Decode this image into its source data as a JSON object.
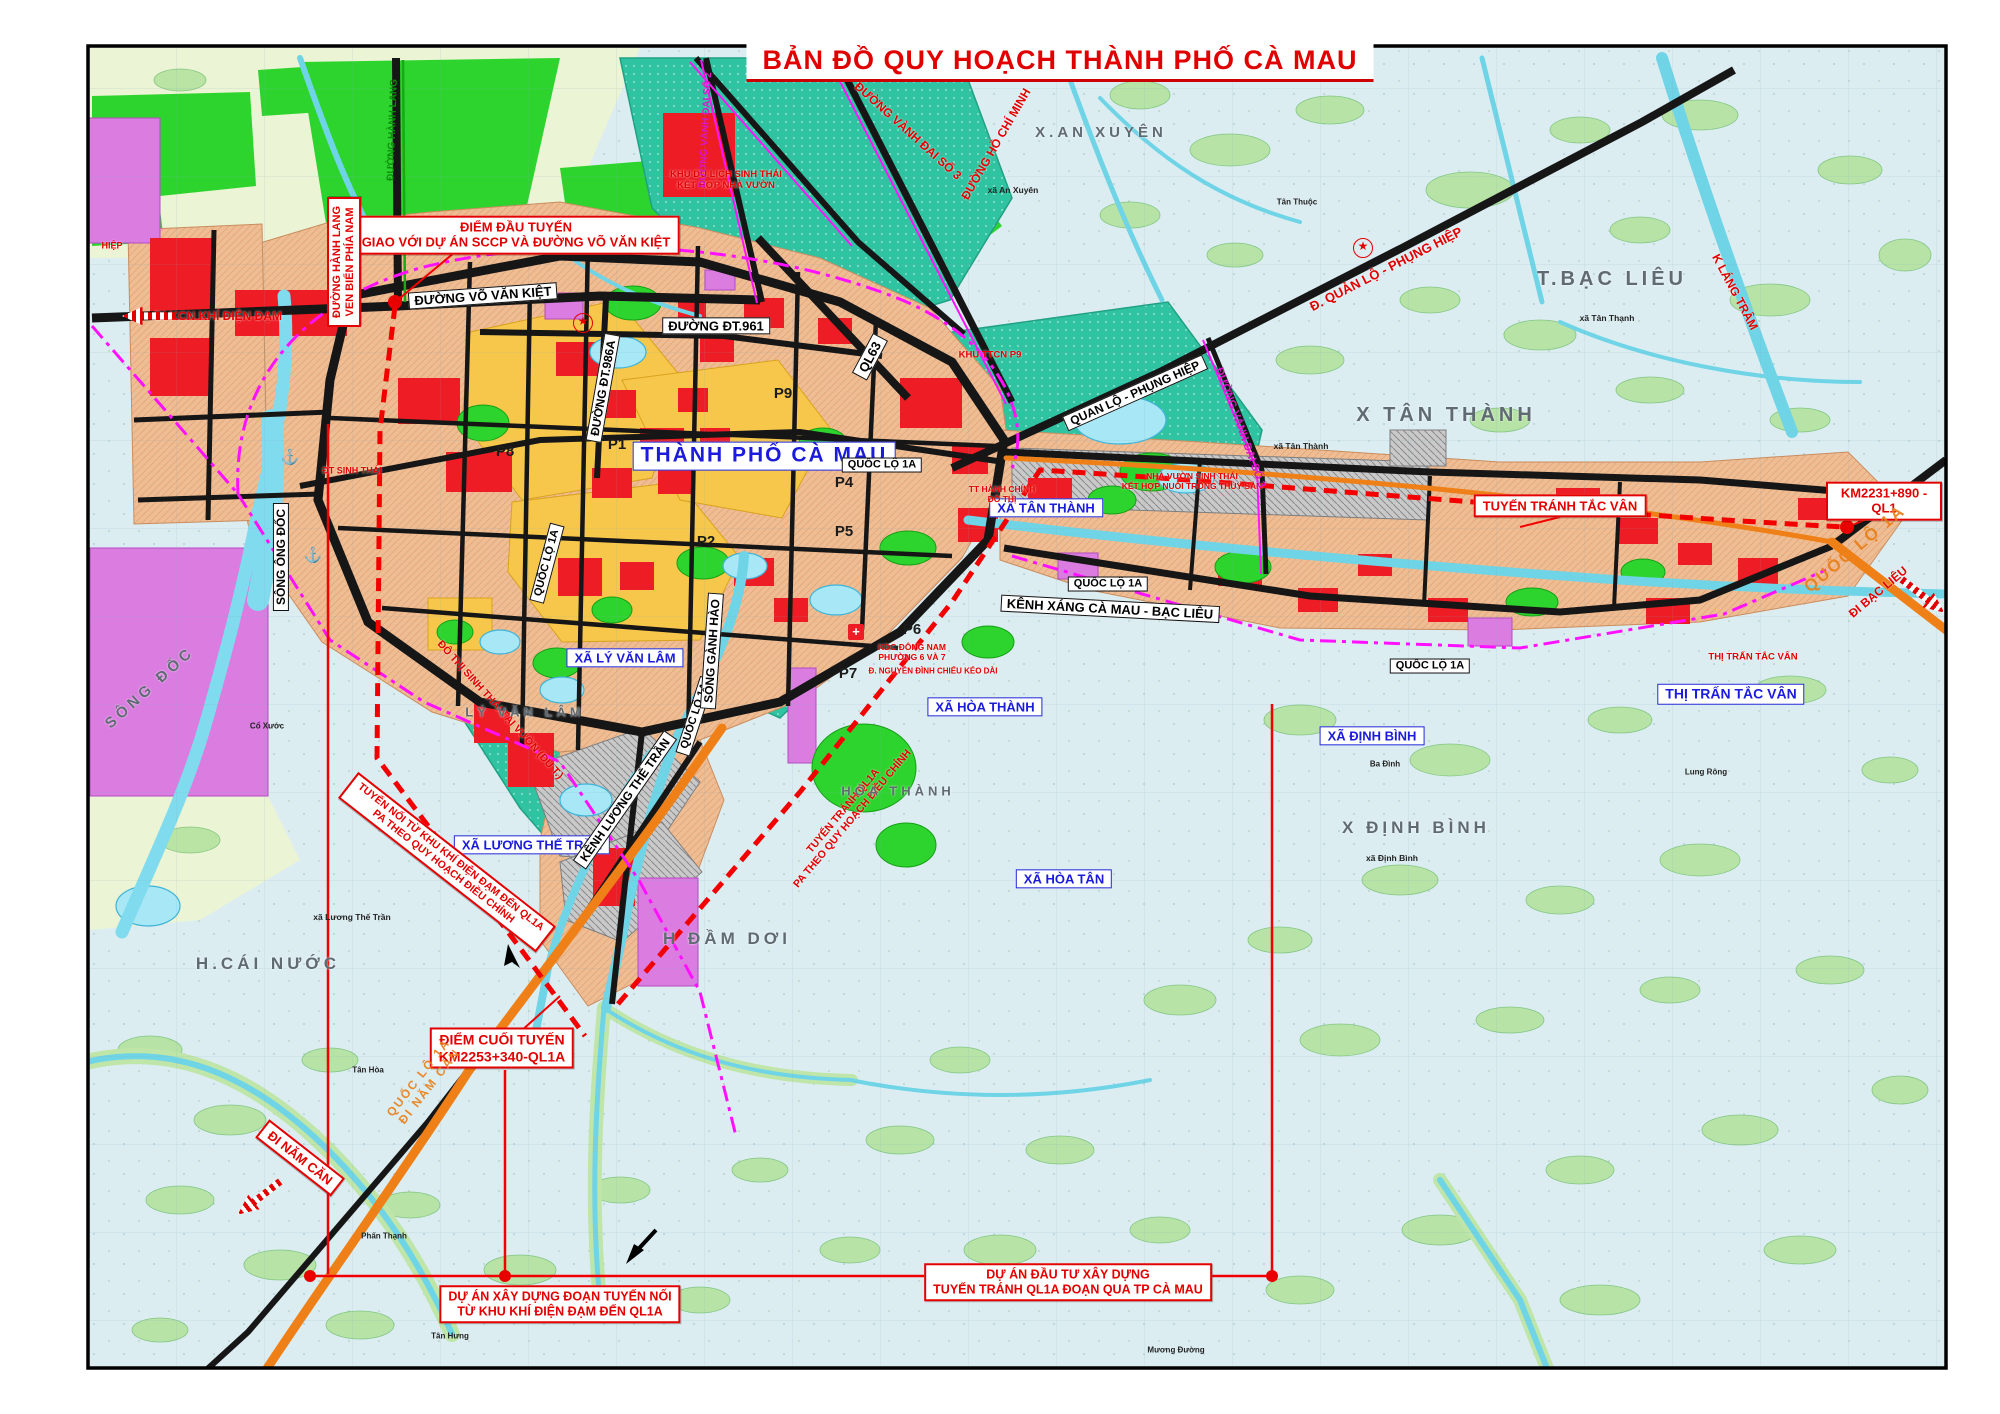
{
  "title": "BẢN ĐỒ QUY HOẠCH THÀNH PHỐ CÀ MAU",
  "colors": {
    "accent_red": "#e30000",
    "label_blue": "#1b1bdb",
    "road_black": "#161616",
    "road_orange": "#ef8018",
    "boundary_magenta": "#ff10ff",
    "urban_salmon": "#eebd93",
    "zone_yellow": "#f6c74a",
    "zone_teal": "#2fc3a2",
    "zone_green": "#2ed42e",
    "zone_magenta": "#da7ce0",
    "water_cyan": "#6fd4e6",
    "base_blue": "#dcedf2"
  },
  "labels": [
    {
      "n": "callout-diem-dau",
      "t": "ĐIỂM ĐẦU TUYẾN\nGIAO VỚI DỰ ÁN SCCP VÀ ĐƯỜNG VÕ VĂN KIỆT",
      "x": 516,
      "y": 235,
      "c": "callout",
      "s": 13
    },
    {
      "n": "roadbox-vo-van-kiet",
      "t": "ĐƯỜNG VÕ VĂN KIỆT",
      "x": 483,
      "y": 296,
      "c": "roadbox",
      "s": 13,
      "r": -4
    },
    {
      "n": "roadbox-dt961",
      "t": "ĐƯỜNG ĐT.961",
      "x": 716,
      "y": 326,
      "c": "roadbox",
      "s": 13
    },
    {
      "n": "roadbox-dt986a",
      "t": "ĐƯỜNG ĐT.986A",
      "x": 603,
      "y": 388,
      "c": "roadbox",
      "s": 12,
      "r": -80
    },
    {
      "n": "roadbox-ql63",
      "t": "QL63",
      "x": 870,
      "y": 357,
      "c": "roadbox",
      "s": 13,
      "r": -62
    },
    {
      "n": "citybox-thanh-pho-ca-mau",
      "t": "THÀNH PHỐ CÀ MAU",
      "x": 764,
      "y": 456,
      "c": "bluebox big",
      "s": 21
    },
    {
      "n": "roadbox-quan-lo-phung-hiep",
      "t": "QUAN LỘ - PHỤNG HIỆP",
      "x": 1135,
      "y": 393,
      "c": "roadbox",
      "s": 12,
      "r": -24
    },
    {
      "n": "bluebox-xa-tan-thanh",
      "t": "XÃ TÂN THÀNH",
      "x": 1046,
      "y": 508,
      "c": "bluebox",
      "s": 13
    },
    {
      "n": "roadbox-quoc-lo-1a-center",
      "t": "QUỐC LỘ 1A",
      "x": 882,
      "y": 465,
      "c": "roadbox",
      "s": 11
    },
    {
      "n": "roadbox-quoc-lo-1a-mid",
      "t": "QUỐC LỘ 1A",
      "x": 1108,
      "y": 584,
      "c": "roadbox",
      "s": 11
    },
    {
      "n": "roadbox-quoc-lo-1a-tac-van",
      "t": "QUỐC LỘ 1A",
      "x": 1430,
      "y": 666,
      "c": "roadbox",
      "s": 11
    },
    {
      "n": "roadbox-quoc-lo-1a-city-north",
      "t": "QUỐC LỘ 1A",
      "x": 547,
      "y": 563,
      "c": "roadbox",
      "s": 11,
      "r": -75
    },
    {
      "n": "roadbox-quoc-lo-1a-city-south",
      "t": "QUỐC LỘ 1A",
      "x": 695,
      "y": 716,
      "c": "roadbox",
      "s": 11,
      "r": -72
    },
    {
      "n": "roadbox-kenh-xang",
      "t": "KÊNH XÁNG CÀ MAU - BẠC LIÊU",
      "x": 1110,
      "y": 609,
      "c": "roadbox",
      "s": 13,
      "r": 3
    },
    {
      "n": "bluebox-xa-ly-van-lam",
      "t": "XÃ LÝ VĂN LÂM",
      "x": 625,
      "y": 658,
      "c": "bluebox",
      "s": 13
    },
    {
      "n": "bluebox-xa-hoa-thanh",
      "t": "XÃ HÒA THÀNH",
      "x": 985,
      "y": 707,
      "c": "bluebox",
      "s": 13
    },
    {
      "n": "bluebox-xa-dinh-binh",
      "t": "XÃ ĐỊNH BÌNH",
      "x": 1372,
      "y": 736,
      "c": "bluebox",
      "s": 13
    },
    {
      "n": "bluebox-thi-tran-tac-van",
      "t": "THỊ TRẤN TẮC VÂN",
      "x": 1731,
      "y": 694,
      "c": "bluebox",
      "s": 14
    },
    {
      "n": "bluebox-xa-luong-the-tran",
      "t": "XÃ LƯƠNG THẾ TRẦN",
      "x": 532,
      "y": 845,
      "c": "bluebox",
      "s": 13
    },
    {
      "n": "bluebox-xa-hoa-tan",
      "t": "XÃ HÒA TÂN",
      "x": 1064,
      "y": 879,
      "c": "bluebox",
      "s": 13
    },
    {
      "n": "callout-tuyen-tranh-tac-van",
      "t": "TUYẾN TRÁNH TẮC VÂN",
      "x": 1560,
      "y": 506,
      "c": "callout",
      "s": 13
    },
    {
      "n": "callout-km2231",
      "t": "KM2231+890 - QL1",
      "x": 1884,
      "y": 501,
      "c": "callout",
      "s": 13
    },
    {
      "n": "callout-diem-cuoi",
      "t": "ĐIỂM CUỐI TUYẾN\nKM2253+340-QL1A",
      "x": 502,
      "y": 1048,
      "c": "callout",
      "s": 14
    },
    {
      "n": "callout-du-an-tuyen-noi",
      "t": "DỰ ÁN XÂY DỰNG ĐOẠN TUYẾN NỐI\nTỪ KHU KHÍ ĐIỆN ĐẠM ĐẾN QL1A",
      "x": 560,
      "y": 1304,
      "c": "callout",
      "s": 12.5
    },
    {
      "n": "callout-du-an-tuyen-tranh",
      "t": "DỰ ÁN ĐẦU TƯ XÂY DỰNG\nTUYẾN TRÁNH QL1A ĐOẠN QUA TP CÀ MAU",
      "x": 1068,
      "y": 1282,
      "c": "callout",
      "s": 12.5
    },
    {
      "n": "callout-tuyen-noi-pa",
      "t": "TUYẾN NỐI TỪ KHU KHÍ ĐIỆN ĐẠM ĐẾN QL1A\nPA THEO QUY HOẠCH ĐIỀU CHỈNH",
      "x": 447,
      "y": 862,
      "c": "callout",
      "s": 10.5,
      "r": 38
    },
    {
      "n": "callout-di-nam-can",
      "t": "ĐI NĂM CĂN",
      "x": 300,
      "y": 1158,
      "c": "callout",
      "s": 13,
      "r": 38
    },
    {
      "n": "callout-hanh-lang-ven-bien",
      "t": "ĐƯỜNG HÀNH LANG\nVEN BIỂN PHÍA NAM",
      "x": 344,
      "y": 262,
      "c": "callout",
      "s": 11,
      "r": -90
    },
    {
      "n": "rednote-di-kcn",
      "t": "ĐI KCN KHÍ ĐIỆN ĐẠM",
      "x": 218,
      "y": 316,
      "c": "rednote",
      "s": 12
    },
    {
      "n": "rednote-khu-du-lich",
      "t": "KHU DU LỊCH SINH THÁI\nKẾT HỢP NHÀ VƯỜN",
      "x": 726,
      "y": 180,
      "c": "rednote",
      "s": 9.5
    },
    {
      "n": "rednote-vanh-dai-3-nw",
      "t": "ĐƯỜNG VÀNH ĐAI SỐ 3",
      "x": 908,
      "y": 131,
      "c": "rednote",
      "s": 12,
      "r": 42
    },
    {
      "n": "rednote-ho-chi-minh",
      "t": "ĐƯỜNG HỒ CHÍ MINH",
      "x": 996,
      "y": 144,
      "c": "rednote",
      "s": 12,
      "r": -60
    },
    {
      "n": "rednote-quan-lo",
      "t": "Đ. QUẢN LỘ - PHỤNG HIỆP",
      "x": 1386,
      "y": 269,
      "c": "rednote",
      "s": 13,
      "r": -27
    },
    {
      "n": "rednote-k-lang-tram",
      "t": "K LÁNG TRÂM",
      "x": 1735,
      "y": 292,
      "c": "rednote",
      "s": 12,
      "r": 62
    },
    {
      "n": "rednote-tt-hanh-chinh",
      "t": "TT HÀNH CHÍNH\nĐÔ THỊ",
      "x": 1002,
      "y": 494,
      "c": "rednote",
      "s": 8.5
    },
    {
      "n": "rednote-khu-ttcn-p9",
      "t": "KHU TTCN P9",
      "x": 990,
      "y": 355,
      "c": "rednote",
      "s": 9.5
    },
    {
      "n": "rednote-nha-vuon",
      "t": "NHÀ VƯỜN SINH THÁI\nKẾT HỢP NUÔI TRỒNG THỦY SẢN",
      "x": 1192,
      "y": 481,
      "c": "rednote",
      "s": 8.5
    },
    {
      "n": "rednote-kdc-dong-nam",
      "t": "KDC ĐÔNG NAM\nPHƯỜNG 6 VÀ 7",
      "x": 912,
      "y": 652,
      "c": "rednote",
      "s": 8.5
    },
    {
      "n": "rednote-nguyen-dinh-chieu",
      "t": "Đ. NGUYỄN ĐÌNH CHIỂU KÉO DÀI",
      "x": 933,
      "y": 671,
      "c": "rednote",
      "s": 8
    },
    {
      "n": "rednote-thi-tran-tac-van",
      "t": "THỊ TRẤN TẮC VÂN",
      "x": 1753,
      "y": 657,
      "c": "rednote",
      "s": 9.5
    },
    {
      "n": "rednote-tuyen-tranh-pa",
      "t": "TUYẾN TRÁNH QL1A\nPA THEO QUY HOẠCH ĐIỀU CHỈNH",
      "x": 848,
      "y": 815,
      "c": "rednote",
      "s": 10.5,
      "r": -50
    },
    {
      "n": "rednote-do-thi-sinh-thai-strip",
      "t": "ĐÔ THỊ SINH THÁI TẠI VƯỜN (DU T.)",
      "x": 500,
      "y": 710,
      "c": "rednote",
      "s": 10.5,
      "r": 48
    },
    {
      "n": "rednote-dt-sinh-thai",
      "t": "ĐT SINH THÁI",
      "x": 352,
      "y": 471,
      "c": "rednote",
      "s": 9
    },
    {
      "n": "rednote-hiep",
      "t": "HIỆP",
      "x": 112,
      "y": 246,
      "c": "rednote",
      "s": 9
    },
    {
      "n": "rednote-di-bac-lieu",
      "t": "ĐI BẠC LIÊU",
      "x": 1878,
      "y": 592,
      "c": "rednote",
      "s": 12,
      "r": -40
    },
    {
      "n": "orange-quoc-lo-1a-east",
      "t": "QUỐC LỘ 1A",
      "x": 1855,
      "y": 549,
      "c": "orangeroad",
      "s": 17,
      "r": -40
    },
    {
      "n": "orange-ql1a-di-nam-can",
      "t": "QUỐC LỘ 1A\nĐI NĂM CĂN",
      "x": 424,
      "y": 1082,
      "c": "orangeroad",
      "s": 12,
      "r": -52
    },
    {
      "n": "magenta-vanh-dai-2",
      "t": "ĐƯỜNG VÀNH ĐAI SỐ 2",
      "x": 706,
      "y": 130,
      "c": "magentaroad",
      "s": 10,
      "r": -87
    },
    {
      "n": "magenta-vanh-dai-3-east",
      "t": "ĐƯỜNG VÀNH ĐAI SỐ 3",
      "x": 1240,
      "y": 428,
      "c": "magentaroad",
      "s": 11,
      "r": 70
    },
    {
      "n": "green-hanh-lang",
      "t": "ĐƯỜNG HÀNH LANG",
      "x": 393,
      "y": 130,
      "c": "greenroad",
      "s": 10,
      "r": -88
    },
    {
      "n": "roadbox-song-ong-doc",
      "t": "SÔNG ÔNG ĐỐC",
      "x": 281,
      "y": 557,
      "c": "roadbox",
      "s": 12,
      "r": -90
    },
    {
      "n": "roadbox-song-ganh-hao",
      "t": "SÔNG GÀNH HÀO",
      "x": 712,
      "y": 651,
      "c": "roadbox",
      "s": 12,
      "r": -86
    },
    {
      "n": "roadbox-kenh-luong-the-tran",
      "t": "KÊNH LƯƠNG THẾ TRẦN",
      "x": 625,
      "y": 800,
      "c": "roadbox",
      "s": 12,
      "r": -55
    },
    {
      "n": "gray-t-bac-lieu",
      "t": "T.BẠC LIÊU",
      "x": 1612,
      "y": 280,
      "c": "graylabel",
      "s": 20
    },
    {
      "n": "gray-x-an-xuyen",
      "t": "X.AN XUYÊN",
      "x": 1101,
      "y": 133,
      "c": "graylabel",
      "s": 15
    },
    {
      "n": "gray-x-tan-thanh",
      "t": "X TÂN THÀNH",
      "x": 1446,
      "y": 416,
      "c": "graylabel",
      "s": 20
    },
    {
      "n": "gray-x-dinh-binh",
      "t": "X ĐỊNH BÌNH",
      "x": 1416,
      "y": 828,
      "c": "graylabel",
      "s": 17
    },
    {
      "n": "gray-h-dam-doi",
      "t": "H ĐẦM DƠI",
      "x": 727,
      "y": 939,
      "c": "graylabel",
      "s": 17
    },
    {
      "n": "gray-h-cai-nuoc",
      "t": "H.CÁI NƯỚC",
      "x": 268,
      "y": 964,
      "c": "graylabel",
      "s": 17
    },
    {
      "n": "gray-ly-van-lam",
      "t": "LÝ VĂN LÂM",
      "x": 525,
      "y": 712,
      "c": "graylabel",
      "s": 13
    },
    {
      "n": "gray-hoa-thanh",
      "t": "HÒA THÀNH",
      "x": 898,
      "y": 791,
      "c": "graylabel",
      "s": 13
    },
    {
      "n": "gray-song-doc",
      "t": "SÔNG ĐỐC",
      "x": 150,
      "y": 688,
      "c": "graylabel",
      "s": 15,
      "r": -42
    },
    {
      "n": "ward-p1",
      "t": "P1",
      "x": 617,
      "y": 445,
      "c": "ward",
      "s": 15
    },
    {
      "n": "ward-p2",
      "t": "P2",
      "x": 706,
      "y": 542,
      "c": "ward",
      "s": 15
    },
    {
      "n": "ward-p4",
      "t": "P4",
      "x": 844,
      "y": 483,
      "c": "ward",
      "s": 15
    },
    {
      "n": "ward-p5",
      "t": "P5",
      "x": 844,
      "y": 532,
      "c": "ward",
      "s": 15
    },
    {
      "n": "ward-p6",
      "t": "P6",
      "x": 912,
      "y": 630,
      "c": "ward",
      "s": 15
    },
    {
      "n": "ward-p7",
      "t": "P7",
      "x": 848,
      "y": 674,
      "c": "ward",
      "s": 15
    },
    {
      "n": "ward-p8",
      "t": "P8",
      "x": 505,
      "y": 452,
      "c": "ward",
      "s": 15
    },
    {
      "n": "ward-p9",
      "t": "P9",
      "x": 783,
      "y": 394,
      "c": "ward",
      "s": 15
    },
    {
      "n": "small-xa-tan-thanh",
      "t": "xã Tân Thành",
      "x": 1301,
      "y": 446,
      "c": "smalllabel",
      "s": 8.5
    },
    {
      "n": "small-xa-an-xuyen",
      "t": "xã An Xuyên",
      "x": 1013,
      "y": 190,
      "c": "smalllabel",
      "s": 8.5
    },
    {
      "n": "small-xa-tan-thanh-2",
      "t": "xã Tân Thạnh",
      "x": 1607,
      "y": 318,
      "c": "smalllabel",
      "s": 8.5
    },
    {
      "n": "small-xa-dinh-binh",
      "t": "xã Định Bình",
      "x": 1392,
      "y": 858,
      "c": "smalllabel",
      "s": 8.5
    },
    {
      "n": "small-xa-luong-the-tran",
      "t": "xã Lương Thế Trần",
      "x": 352,
      "y": 917,
      "c": "smalllabel",
      "s": 8.5
    },
    {
      "n": "small-tan-hoa",
      "t": "Tân Hòa",
      "x": 368,
      "y": 1070,
      "c": "smalllabel",
      "s": 8
    },
    {
      "n": "small-phan-thanh",
      "t": "Phấn Thạnh",
      "x": 384,
      "y": 1236,
      "c": "smalllabel",
      "s": 8
    },
    {
      "n": "small-tan-hung",
      "t": "Tân Hưng",
      "x": 450,
      "y": 1336,
      "c": "smalllabel",
      "s": 8
    },
    {
      "n": "small-muong-duong",
      "t": "Mương Đường",
      "x": 1176,
      "y": 1350,
      "c": "smalllabel",
      "s": 8
    },
    {
      "n": "small-ba-dinh",
      "t": "Ba Đình",
      "x": 1385,
      "y": 764,
      "c": "smalllabel",
      "s": 8
    },
    {
      "n": "small-lung-rong",
      "t": "Lung Rông",
      "x": 1706,
      "y": 772,
      "c": "smalllabel",
      "s": 8
    },
    {
      "n": "small-tan-thuoc",
      "t": "Tân Thuộc",
      "x": 1297,
      "y": 202,
      "c": "smalllabel",
      "s": 8
    },
    {
      "n": "small-co-xuoc",
      "t": "Cổ Xước",
      "x": 267,
      "y": 726,
      "c": "smalllabel",
      "s": 8
    },
    {
      "n": "anchor-icon-1",
      "t": "⚓",
      "x": 290,
      "y": 458,
      "c": "anchor",
      "s": 15
    },
    {
      "n": "anchor-icon-2",
      "t": "⚓",
      "x": 313,
      "y": 556,
      "c": "anchor",
      "s": 15
    },
    {
      "n": "star-icon-1",
      "t": "★",
      "x": 1363,
      "y": 248,
      "c": "starsym",
      "s": 12
    },
    {
      "n": "star-icon-2",
      "t": "★",
      "x": 583,
      "y": 323,
      "c": "starsym",
      "s": 12
    },
    {
      "n": "hospital-icon",
      "t": "+",
      "x": 856,
      "y": 632,
      "c": "hospital",
      "s": 13
    }
  ]
}
